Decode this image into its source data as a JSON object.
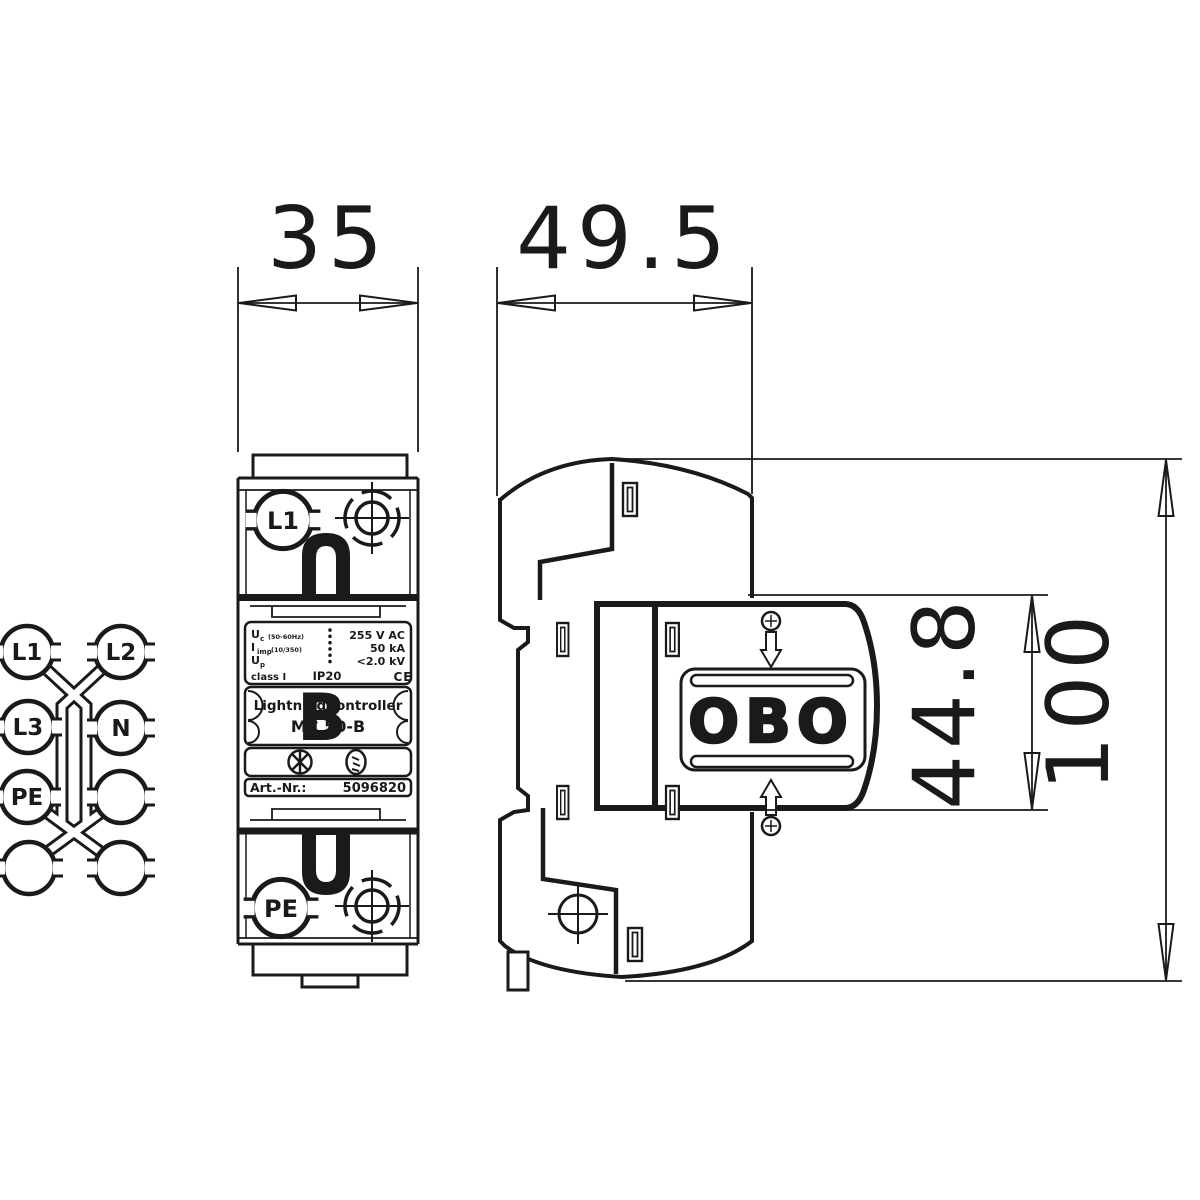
{
  "page": {
    "background": "#ffffff",
    "line_color": "#1a1a1a"
  },
  "dimensions": {
    "front_width": "35",
    "side_depth": "49.5",
    "module_height": "44.8",
    "total_height": "100"
  },
  "front_view": {
    "terminal_top": "L1",
    "terminal_bottom": "PE",
    "label": {
      "rows": [
        {
          "main": "U",
          "sub": "c",
          "note": "(50-60Hz)",
          "value": "255 V AC"
        },
        {
          "main": "I",
          "sub": "imp",
          "note": "(10/350)",
          "value": "50 kA"
        },
        {
          "main": "U",
          "sub": "p",
          "note": "",
          "value": "<2.0 kV"
        },
        {
          "main": "class I",
          "sub": "",
          "note": "",
          "value": ""
        }
      ],
      "ip_rating": "IP20",
      "ce_mark": "CE",
      "product_line1": "LightningController",
      "product_line2": "MC 50-B",
      "watermark": "B",
      "art_label": "Art.-Nr.:",
      "art_number": "5096820"
    }
  },
  "side_view": {
    "logo": "OBO"
  },
  "schematic": {
    "labels": [
      "L1",
      "L2",
      "L3",
      "N",
      "PE"
    ]
  }
}
